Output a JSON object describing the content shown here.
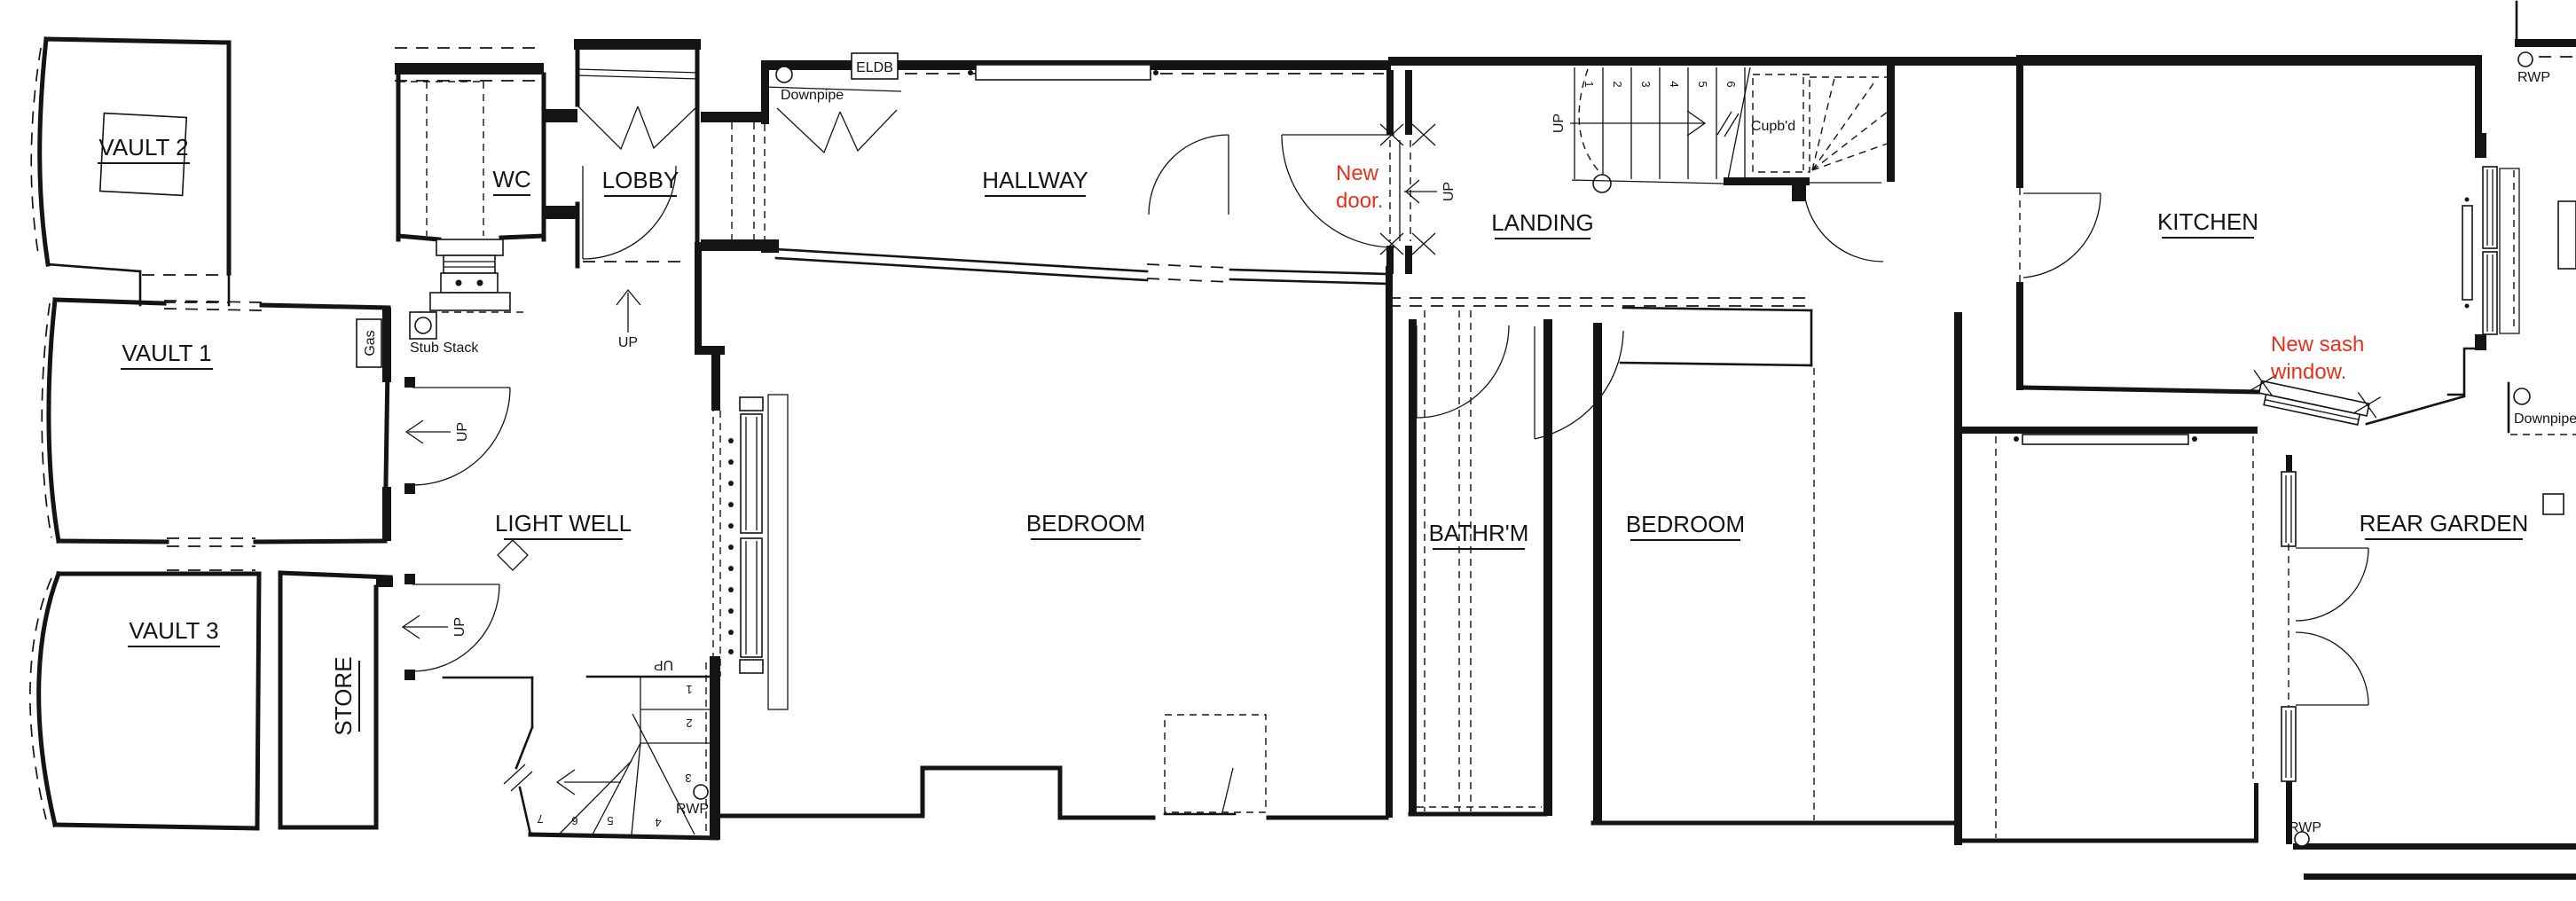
{
  "drawing": {
    "kind": "architectural floor plan",
    "background": "#ffffff",
    "line_color": "#141414",
    "annotation_color": "#e8311c"
  },
  "rooms": {
    "vault2": "VAULT 2",
    "vault1": "VAULT 1",
    "vault3": "VAULT 3",
    "store": "STORE",
    "wc": "WC",
    "lobby": "LOBBY",
    "light_well": "LIGHT WELL",
    "hallway": "HALLWAY",
    "bedroom1": "BEDROOM",
    "landing": "LANDING",
    "bathroom": "BATHR'M",
    "bedroom2": "BEDROOM",
    "kitchen": "KITCHEN",
    "rear_garden": "REAR  GARDEN"
  },
  "annotations": {
    "new_door": [
      "New",
      "door."
    ],
    "new_sash_window": [
      "New sash",
      "window."
    ]
  },
  "fixtures": {
    "downpipe": "Downpipe",
    "rwp": "RWP",
    "stub_stack": "Stub Stack",
    "gas": "Gas",
    "eldb": "ELDB",
    "cupboard": "Cupb'd",
    "up": "UP"
  },
  "stairs": {
    "landing": {
      "direction": "UP",
      "treads": [
        "1",
        "2",
        "3",
        "4",
        "5",
        "6"
      ]
    },
    "winder": {
      "direction": "UP",
      "treads": [
        "1",
        "2",
        "3",
        "4",
        "5",
        "6",
        "7"
      ]
    }
  }
}
